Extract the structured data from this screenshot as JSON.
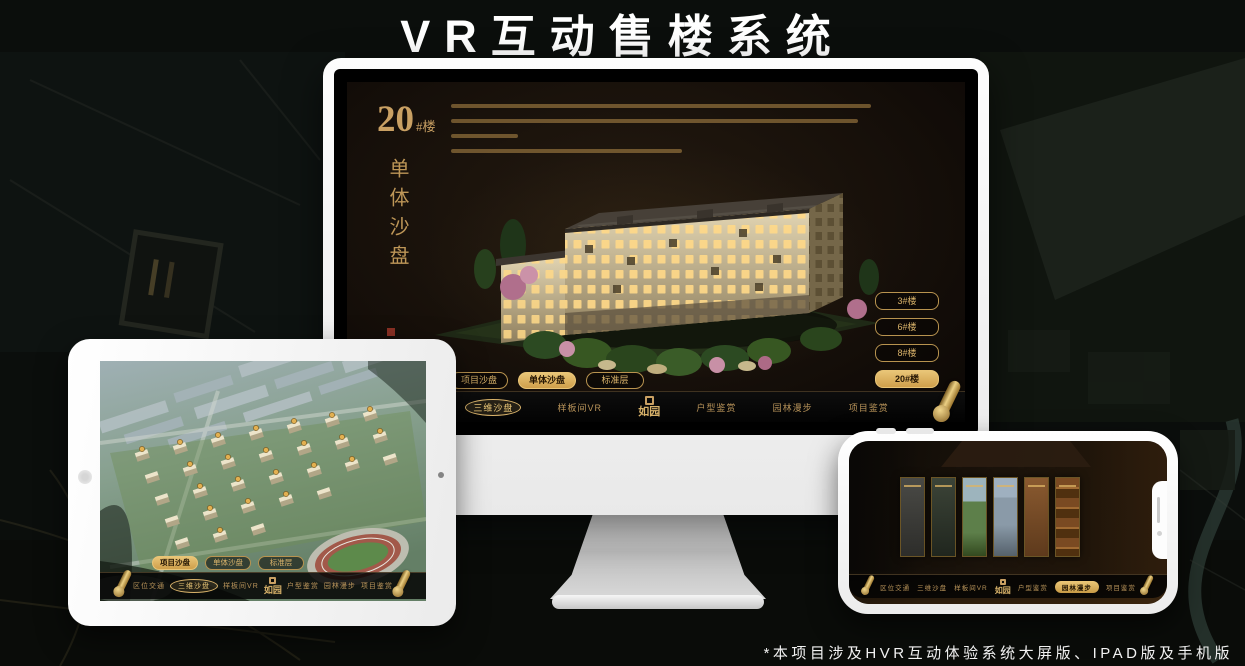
{
  "header": {
    "title": "VR互动售楼系统"
  },
  "footnote": {
    "text": "*本项目涉及HVR互动体验系统大屏版、IPAD版及手机版"
  },
  "app": {
    "logo_text": "如园",
    "mode_tabs": [
      "项目沙盘",
      "单体沙盘",
      "标准层"
    ],
    "nav_items": [
      "区位交通",
      "三维沙盘",
      "样板间VR",
      "户型鉴赏",
      "园林漫步",
      "项目鉴赏"
    ],
    "monitor": {
      "heading_number": "20",
      "heading_suffix": "#楼",
      "heading_vertical": "单体沙盘",
      "floor_buttons": [
        "3#楼",
        "6#楼",
        "8#楼",
        "20#楼"
      ],
      "active_floor": "20#楼",
      "active_mode_tab": "单体沙盘",
      "active_nav_item": "三维沙盘"
    },
    "ipad": {
      "active_mode_tab": "项目沙盘",
      "active_nav_item": "三维沙盘"
    },
    "phone": {
      "active_nav_item": "园林漫步"
    }
  },
  "colors": {
    "gold": "#c9a063",
    "gold_bright": "#ecc878",
    "active_tab_bg": "#d8aa57",
    "screen_bg": "#17100a",
    "navbar_bg": "#060606",
    "device_frame": "#f5f5f5"
  }
}
